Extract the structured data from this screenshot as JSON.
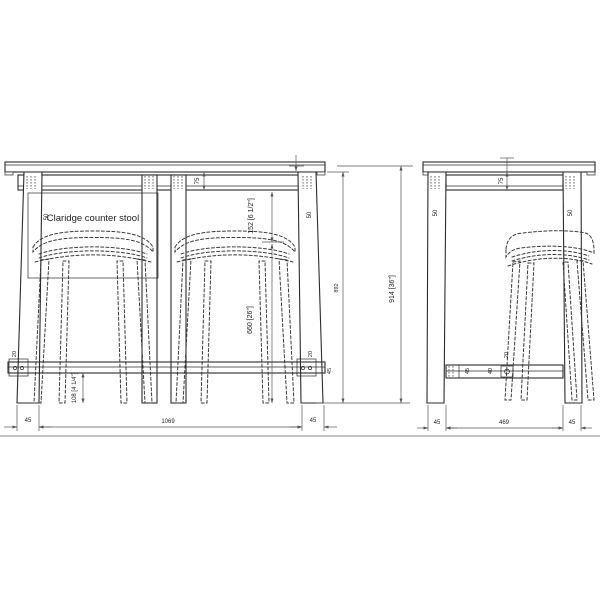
{
  "drawing": {
    "product_label": "Claridge counter stool",
    "front_view": {
      "dims": {
        "apron_height": "75",
        "leg_left": "50",
        "leg_right": "50",
        "counter_to_seat": "152 [6 1/2\"]",
        "seat_height": "660 [26\"]",
        "underside_height": "892",
        "overall_height": "914 [36\"]",
        "rail_left_thickness": "20",
        "rail_right_thickness": "20",
        "rail_bracket_width": "45",
        "rail_to_floor": "108 [4 1/4\"]",
        "overall_width": "1069",
        "foot_left": "45",
        "foot_right": "45"
      }
    },
    "side_view": {
      "dims": {
        "apron_height": "75",
        "leg_front": "50",
        "leg_rear": "50",
        "rail_width": "45",
        "rail_inner": "40",
        "rail_bolt": "20",
        "depth_inner": "469",
        "foot_front": "45",
        "foot_rear": "45"
      }
    }
  }
}
